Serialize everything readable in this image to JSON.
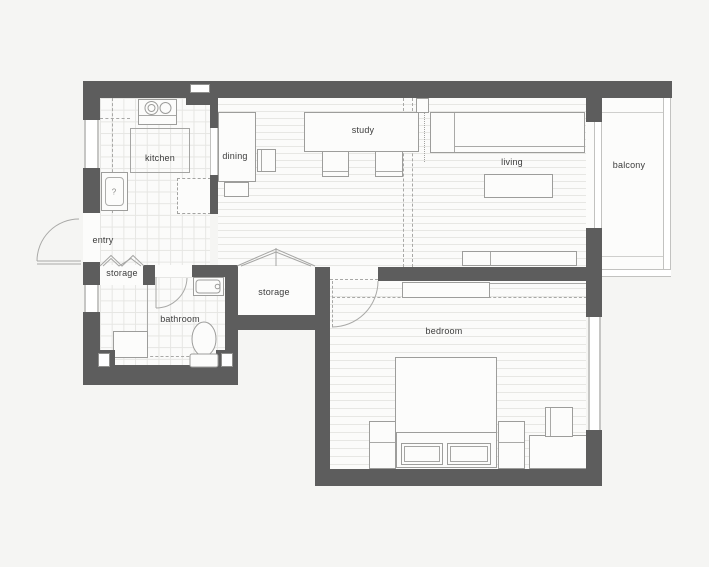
{
  "title": "apartment floor plan",
  "rooms": {
    "kitchen": "kitchen",
    "dining": "dining",
    "study": "study",
    "living": "living",
    "balcony": "balcony",
    "entry": "entry",
    "storage_hall": "storage",
    "storage_inner": "storage",
    "bathroom": "bathroom",
    "bedroom": "bedroom"
  },
  "marks": {
    "washer": "?"
  },
  "colors": {
    "wall": "#5d5d5d",
    "background": "#f5f5f3",
    "floor": "#fcfcfb",
    "floor_line": "#e7e7e4",
    "furniture_line": "#9d9d9b",
    "window_frame": "#c6c6c4",
    "label_text": "#3c3c3c"
  }
}
